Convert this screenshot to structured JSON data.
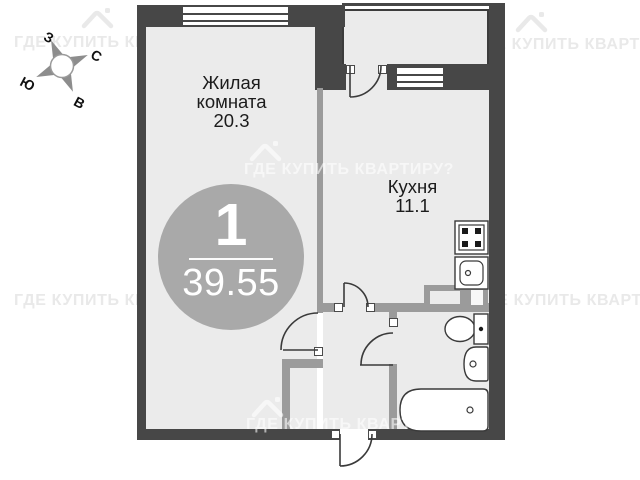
{
  "watermark": {
    "text": "ГДЕ КУПИТЬ КВАРТИРУ?"
  },
  "compass": {
    "north": "С",
    "south": "Ю",
    "west": "З",
    "east": "В"
  },
  "badge": {
    "rooms": "1",
    "total_area": "39.55"
  },
  "rooms": {
    "living": {
      "name_line1": "Жилая",
      "name_line2": "комната",
      "area": "20.3"
    },
    "kitchen": {
      "name": "Кухня",
      "area": "11.1"
    }
  },
  "icons": {
    "compass": "compass-rose",
    "house": "house-watermark-icon",
    "stove": "stove-icon",
    "kitchen_sink": "kitchen-sink-icon",
    "toilet": "toilet-icon",
    "washbasin": "washbasin-icon",
    "bathtub": "bathtub-icon"
  },
  "colors": {
    "background": "#ffffff",
    "wall_dark": "#474747",
    "wall_partition": "#9b9b9b",
    "floor": "#ebebeb",
    "badge": "#a9a9a9",
    "text": "#1c1c1c",
    "watermark_outside": "#e9e9e9"
  }
}
